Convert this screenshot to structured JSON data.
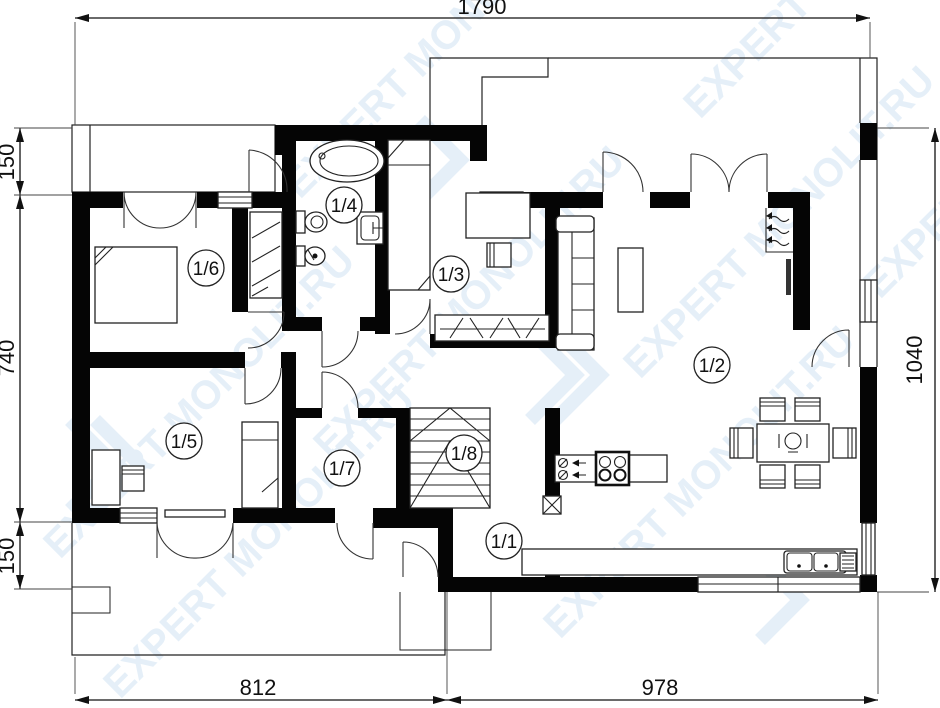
{
  "watermark": {
    "text": "EXPERT MONOLIT.RU",
    "color": "#cfe2f2"
  },
  "dimensions": {
    "top": "1790",
    "left_top": "150",
    "left_middle": "740",
    "left_bottom": "150",
    "right": "1040",
    "bottom_left": "812",
    "bottom_right": "978"
  },
  "rooms": [
    {
      "id": "1-1",
      "label": "1/1"
    },
    {
      "id": "1-2",
      "label": "1/2"
    },
    {
      "id": "1-3",
      "label": "1/3"
    },
    {
      "id": "1-4",
      "label": "1/4"
    },
    {
      "id": "1-5",
      "label": "1/5"
    },
    {
      "id": "1-6",
      "label": "1/6"
    },
    {
      "id": "1-7",
      "label": "1/7"
    },
    {
      "id": "1-8",
      "label": "1/8"
    }
  ],
  "colors": {
    "wall": "#050505",
    "line": "#222222",
    "watermark": "#cfe2f2"
  }
}
